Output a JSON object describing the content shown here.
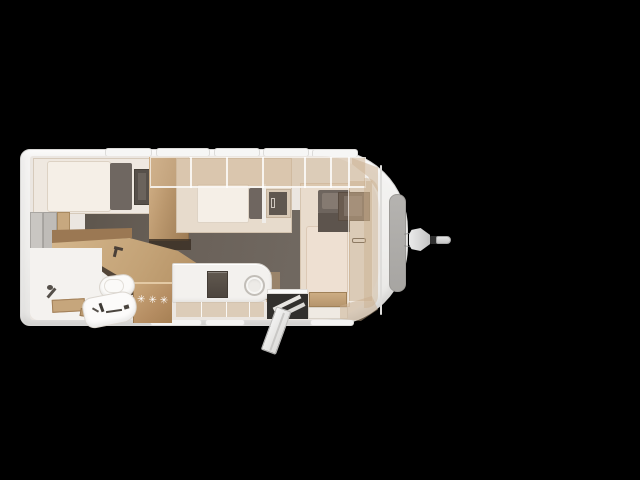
{
  "scene": {
    "description": "caravan floor plan, top view, on black background",
    "background_color": "#000000"
  },
  "caravan": {
    "heater_marking": "✳✳✳",
    "palette": {
      "shell": "#f2f1ef",
      "floor_dark": "#6a6159",
      "wood": "#c2a178",
      "overhead_lockers": "rgba(206,177,143,0.5)",
      "mattress": "#f5efe7",
      "upholstery_dark_gray": "#6f6660",
      "front_window_gray": "#aeacaa"
    },
    "zones": [
      {
        "name": "rear-single-bed"
      },
      {
        "name": "left-wall-cabinets"
      },
      {
        "name": "bunk-partition"
      },
      {
        "name": "middle-bed"
      },
      {
        "name": "overhead-lockers"
      },
      {
        "name": "front-transverse-bed"
      },
      {
        "name": "front-wardrobe"
      },
      {
        "name": "kitchen-corner-counter"
      },
      {
        "name": "heater-cabinet"
      },
      {
        "name": "kitchen-unit-hob-and-sink"
      },
      {
        "name": "entry-door-open-with-steps"
      },
      {
        "name": "washroom-with-toilet-and-vanity"
      },
      {
        "name": "front-window"
      },
      {
        "name": "tow-hitch"
      }
    ]
  }
}
